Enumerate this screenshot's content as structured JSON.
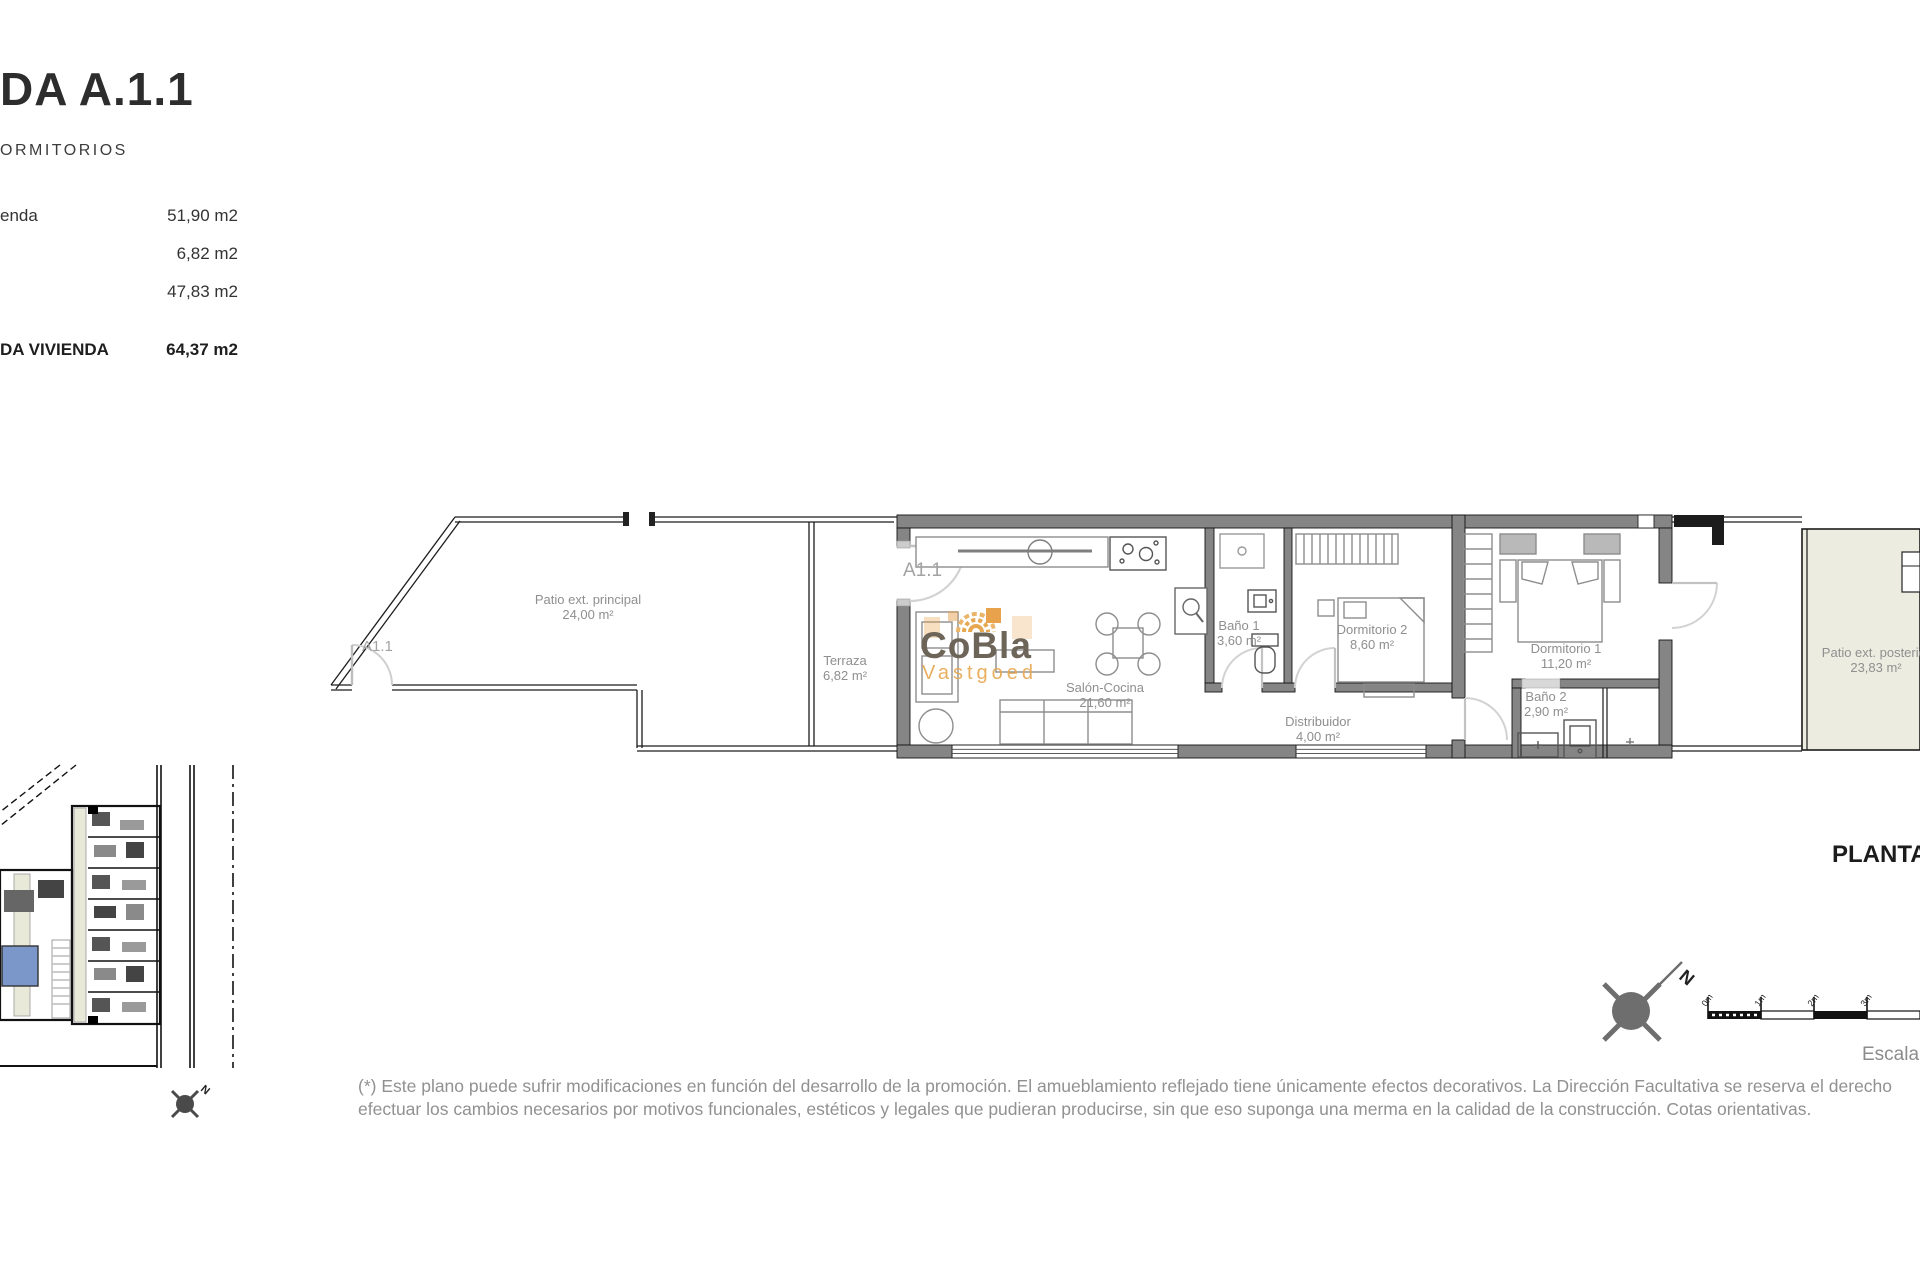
{
  "header": {
    "title": "DA A.1.1",
    "subtitle": "ORMITORIOS",
    "rows": [
      {
        "label": "enda",
        "value": "51,90 m2"
      },
      {
        "label": "",
        "value": "6,82 m2"
      },
      {
        "label": "",
        "value": "47,83 m2"
      }
    ],
    "total_label": "DA VIVIENDA",
    "total_value": "64,37 m2"
  },
  "plan": {
    "entrance_label": "A1.1",
    "patio_gate_label": "A1.1",
    "rooms": {
      "patio_principal": {
        "name": "Patio ext. principal",
        "area": "24,00 m²"
      },
      "terraza": {
        "name": "Terraza",
        "area": "6,82 m²"
      },
      "salon": {
        "name": "Salón-Cocina",
        "area": "21,60 m²"
      },
      "bano1": {
        "name": "Baño 1",
        "area": "3,60 m²"
      },
      "dormitorio2": {
        "name": "Dormitorio 2",
        "area": "8,60 m²"
      },
      "distribuidor": {
        "name": "Distribuidor",
        "area": "4,00 m²"
      },
      "dormitorio1": {
        "name": "Dormitorio 1",
        "area": "11,20 m²"
      },
      "bano2": {
        "name": "Baño 2",
        "area": "2,90 m²"
      },
      "patio_posterior": {
        "name": "Patio ext. posterior",
        "area": "23,83 m²"
      }
    }
  },
  "watermark": {
    "brand": "CoBla",
    "sub": "Vastgoed"
  },
  "footer": {
    "plan_title": "PLANTA",
    "scale_word": "Escala",
    "scale_ticks": [
      "0m",
      "1m",
      "2m",
      "3m"
    ],
    "north_letter": "N",
    "disclaimer1": "(*) Este plano puede sufrir modificaciones en función del desarrollo de la promoción. El amueblamiento reflejado tiene únicamente efectos decorativos. La Dirección Facultativa se reserva el derecho",
    "disclaimer2": "efectuar los cambios necesarios por motivos funcionales, estéticos y legales que pudieran producirse, sin que eso suponga una merma en la calidad de la construcción. Cotas orientativas."
  },
  "colors": {
    "wall_gray": "#858585",
    "accent_orange": "#e7a750",
    "patio_fill": "#ecede0",
    "label_gray": "#8f8f8f",
    "site_blue": "#7b96c8"
  }
}
